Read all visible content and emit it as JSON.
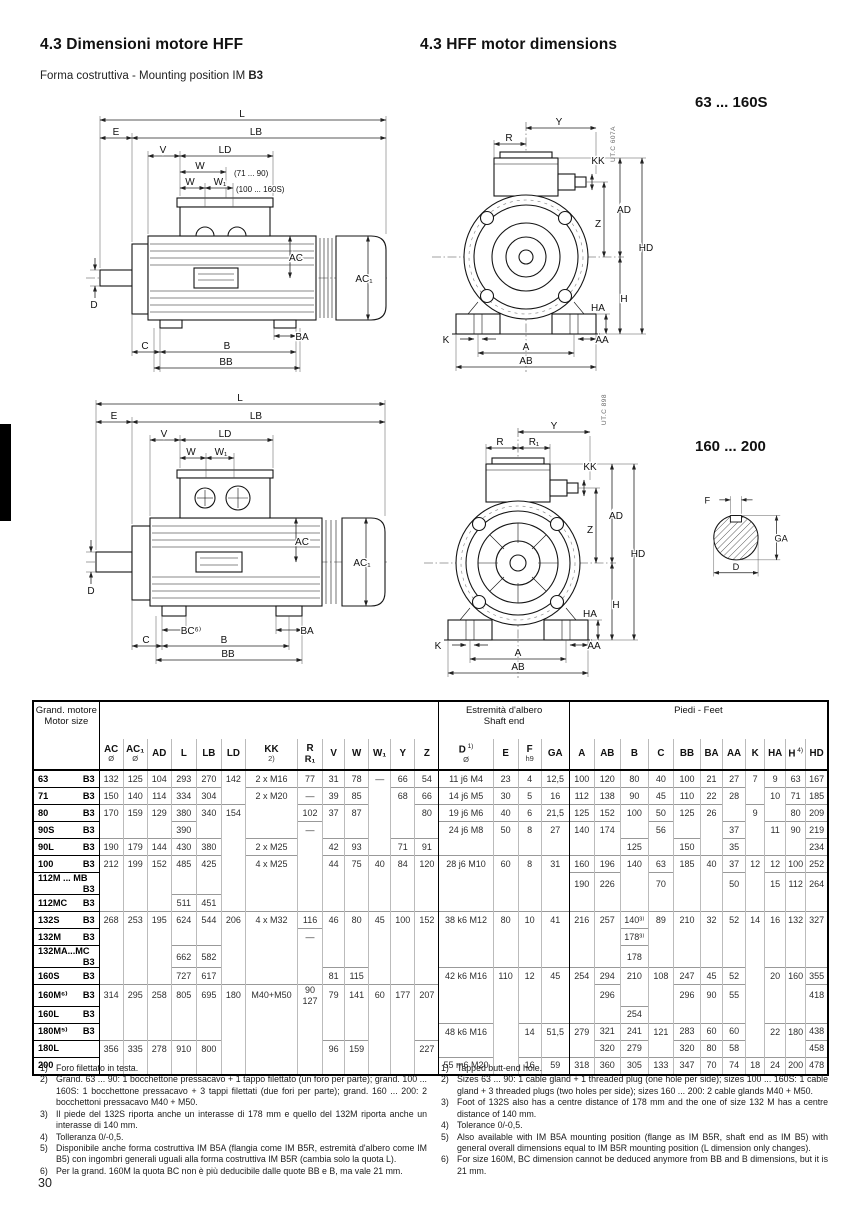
{
  "header": {
    "title_it": "4.3 Dimensioni motore HFF",
    "title_en": "4.3 HFF motor dimensions",
    "subtitle_prefix": "Forma costruttiva - Mounting position IM ",
    "subtitle_bold": "B3"
  },
  "sections": {
    "top_range": "63 ... 160S",
    "bottom_range": "160 ... 200",
    "top_code": "UT.C  607A",
    "bottom_code": "UT.C  898"
  },
  "page": {
    "number": "30"
  },
  "dim": {
    "L": "L",
    "LB": "LB",
    "E": "E",
    "V": "V",
    "LD": "LD",
    "W": "W",
    "W1": "W₁",
    "r7190": "(71  ...  90)",
    "r100160": "(100 ... 160S)",
    "AC": "AC",
    "AC1": "AC₁",
    "D": "D",
    "BA": "BA",
    "C": "C",
    "B": "B",
    "BB": "BB",
    "BC": "BC⁶⁾",
    "Y": "Y",
    "R": "R",
    "R1": "R₁",
    "KK": "KK",
    "AD": "AD",
    "Z": "Z",
    "HD": "HD",
    "HA": "HA",
    "H": "H",
    "K": "K",
    "AA": "AA",
    "A": "A",
    "AB": "AB",
    "F": "F",
    "GA": "GA"
  },
  "table": {
    "motor_size_l1": "Grand. motore",
    "motor_size_l2": "Motor size",
    "shaft_end_l1": "Estremità d'albero",
    "shaft_end_l2": "Shaft end",
    "feet": "Piedi - Feet",
    "columns": [
      {
        "key": "AC",
        "label": "AC",
        "sub": "Ø"
      },
      {
        "key": "AC1",
        "label": "AC₁",
        "sub": "Ø"
      },
      {
        "key": "AD",
        "label": "AD"
      },
      {
        "key": "L",
        "label": "L"
      },
      {
        "key": "LB",
        "label": "LB"
      },
      {
        "key": "LD",
        "label": "LD"
      },
      {
        "key": "KK",
        "label": "KK",
        "sub": "2)"
      },
      {
        "key": "R",
        "label": "R",
        "sub": "R₁",
        "subBold": true
      },
      {
        "key": "V",
        "label": "V"
      },
      {
        "key": "W",
        "label": "W"
      },
      {
        "key": "W1",
        "label": "W₁"
      },
      {
        "key": "Y",
        "label": "Y"
      },
      {
        "key": "Z",
        "label": "Z"
      },
      {
        "key": "D",
        "label": "D",
        "note": "1)",
        "sub": "Ø",
        "bl": true
      },
      {
        "key": "E",
        "label": "E"
      },
      {
        "key": "F",
        "label": "F",
        "sub": "h9"
      },
      {
        "key": "GA",
        "label": "GA"
      },
      {
        "key": "A",
        "label": "A",
        "bl": true
      },
      {
        "key": "AB",
        "label": "AB"
      },
      {
        "key": "B",
        "label": "B"
      },
      {
        "key": "C",
        "label": "C"
      },
      {
        "key": "BB",
        "label": "BB"
      },
      {
        "key": "BA",
        "label": "BA"
      },
      {
        "key": "AA",
        "label": "AA"
      },
      {
        "key": "K",
        "label": "K"
      },
      {
        "key": "HA",
        "label": "HA"
      },
      {
        "key": "H",
        "label": "H",
        "note": "4)"
      },
      {
        "key": "HD",
        "label": "HD"
      }
    ],
    "rows": [
      {
        "size": "63",
        "mount": "B3",
        "cells": [
          "132",
          "125",
          "104",
          "293",
          "270",
          "142",
          "2 x M16",
          "77",
          "31",
          "78",
          "—",
          "66",
          "54",
          "11 j6 M4",
          "23",
          "4",
          "12,5",
          "100",
          "120",
          "80",
          "40",
          "100",
          "21",
          "27",
          "7",
          "9",
          "63",
          "167"
        ]
      },
      {
        "size": "71",
        "mount": "B3",
        "cells": [
          "150",
          "140",
          "114",
          "334",
          "304",
          "",
          "2 x M20",
          "—",
          "39",
          "85",
          "",
          "68",
          "66",
          "14 j6 M5",
          "30",
          "5",
          "16",
          "112",
          "138",
          "90",
          "45",
          "110",
          "22",
          "28",
          "",
          "10",
          "71",
          "185"
        ]
      },
      {
        "size": "80",
        "mount": "B3",
        "cells": [
          "170",
          "159",
          "129",
          "380",
          "340",
          "154",
          "",
          "102",
          "37",
          "87",
          "",
          "",
          "80",
          "19 j6 M6",
          "40",
          "6",
          "21,5",
          "125",
          "152",
          "100",
          "50",
          "125",
          "26",
          "",
          "9",
          "",
          "80",
          "209"
        ]
      },
      {
        "size": "90S",
        "mount": "B3",
        "cells": [
          "",
          "",
          "",
          "390",
          "",
          "",
          "",
          "—",
          "",
          "",
          "",
          "",
          "",
          "24 j6 M8",
          "50",
          "8",
          "27",
          "140",
          "174",
          "",
          "56",
          "",
          "",
          "37",
          "",
          "11",
          "90",
          "219"
        ]
      },
      {
        "size": "90L",
        "mount": "B3",
        "cells": [
          "190",
          "179",
          "144",
          "430",
          "380",
          "",
          "2 x M25",
          "",
          "42",
          "93",
          "",
          "71",
          "91",
          "",
          "",
          "",
          "",
          "",
          "",
          "125",
          "",
          "150",
          "",
          "35",
          "",
          "",
          "",
          "234"
        ]
      },
      {
        "size": "100",
        "mount": "B3",
        "cells": [
          "212",
          "199",
          "152",
          "485",
          "425",
          "",
          "4 x M25",
          "",
          "44",
          "75",
          "40",
          "84",
          "120",
          "28 j6 M10",
          "60",
          "8",
          "31",
          "160",
          "196",
          "140",
          "63",
          "185",
          "40",
          "37",
          "12",
          "12",
          "100",
          "252"
        ]
      },
      {
        "size": "112M ... MB",
        "mount": "B3",
        "cells": [
          "",
          "",
          "",
          "",
          "",
          "",
          "",
          "",
          "",
          "",
          "",
          "",
          "",
          "",
          "",
          "",
          "",
          "190",
          "226",
          "",
          "70",
          "",
          "",
          "50",
          "",
          "15",
          "112",
          "264"
        ]
      },
      {
        "size": "112MC",
        "mount": "B3",
        "cells": [
          "",
          "",
          "",
          "511",
          "451",
          "",
          "",
          "",
          "",
          "",
          "",
          "",
          "",
          "",
          "",
          "",
          "",
          "",
          "",
          "",
          "",
          "",
          "",
          "",
          "",
          "",
          "",
          ""
        ]
      },
      {
        "size": "132S",
        "mount": "B3",
        "cells": [
          "268",
          "253",
          "195",
          "624",
          "544",
          "206",
          "4 x M32",
          "116",
          "46",
          "80",
          "45",
          "100",
          "152",
          "38 k6 M12",
          "80",
          "10",
          "41",
          "216",
          "257",
          "140³⁾",
          "89",
          "210",
          "32",
          "52",
          "14",
          "16",
          "132",
          "327"
        ]
      },
      {
        "size": "132M",
        "mount": "B3",
        "cells": [
          "",
          "",
          "",
          "",
          "",
          "",
          "",
          "—",
          "",
          "",
          "",
          "",
          "",
          "",
          "",
          "",
          "",
          "",
          "",
          "178³⁾",
          "",
          "",
          "",
          "",
          "",
          "",
          "",
          ""
        ]
      },
      {
        "size": "132MA...MC",
        "mount": "B3",
        "cells": [
          "",
          "",
          "",
          "662",
          "582",
          "",
          "",
          "",
          "",
          "",
          "",
          "",
          "",
          "",
          "",
          "",
          "",
          "",
          "",
          "178",
          "",
          "",
          "",
          "",
          "",
          "",
          "",
          ""
        ]
      },
      {
        "size": "160S",
        "mount": "B3",
        "cells": [
          "",
          "",
          "",
          "727",
          "617",
          "",
          "",
          "",
          "81",
          "115",
          "",
          "",
          "",
          "42 k6 M16",
          "110",
          "12",
          "45",
          "254",
          "294",
          "210",
          "108",
          "247",
          "45",
          "52",
          "",
          "20",
          "160",
          "355"
        ]
      },
      {
        "size": "160M⁶⁾",
        "mount": "B3",
        "cells": [
          "314",
          "295",
          "258",
          "805",
          "695",
          "180",
          "M40+M50",
          "90\n127",
          "79",
          "141",
          "60",
          "177",
          "207",
          "",
          "",
          "",
          "",
          "",
          "296",
          "",
          "",
          "296",
          "90",
          "55",
          "",
          "",
          "",
          "418"
        ]
      },
      {
        "size": "160L",
        "mount": "B3",
        "cells": [
          "",
          "",
          "",
          "",
          "",
          "",
          "",
          "",
          "",
          "",
          "",
          "",
          "",
          "",
          "",
          "",
          "",
          "",
          "",
          "254",
          "",
          "",
          "",
          "",
          "",
          "",
          "",
          ""
        ]
      },
      {
        "size": "180M⁵⁾",
        "mount": "B3",
        "cells": [
          "",
          "",
          "",
          "",
          "",
          "",
          "",
          "",
          "",
          "",
          "",
          "",
          "",
          "48 k6 M16",
          "",
          "14",
          "51,5",
          "279",
          "321",
          "241",
          "121",
          "283",
          "60",
          "60",
          "",
          "22",
          "180",
          "438"
        ]
      },
      {
        "size": "180L",
        "mount": "",
        "cells": [
          "356",
          "335",
          "278",
          "910",
          "800",
          "",
          "",
          "",
          "96",
          "159",
          "",
          "",
          "227",
          "",
          "",
          "",
          "",
          "",
          "320",
          "279",
          "",
          "320",
          "80",
          "58",
          "",
          "",
          "",
          "458"
        ]
      },
      {
        "size": "200",
        "mount": "",
        "cells": [
          "",
          "",
          "",
          "",
          "",
          "",
          "",
          "",
          "",
          "",
          "",
          "",
          "",
          "55 m6 M20",
          "",
          "16",
          "59",
          "318",
          "360",
          "305",
          "133",
          "347",
          "70",
          "74",
          "18",
          "24",
          "200",
          "478"
        ]
      }
    ]
  },
  "footnotes": {
    "it": [
      {
        "n": "1)",
        "t": "Foro filettato in testa."
      },
      {
        "n": "2)",
        "t": "Grand. 63 ... 90: 1 bocchettone pressacavo + 1 tappo filettato (un foro per parte); grand. 100 ... 160S: 1 bocchettone pressacavo + 3 tappi filettati (due fori per parte); grand. 160 ... 200: 2 bocchettoni pressacavo M40 + M50."
      },
      {
        "n": "3)",
        "t": "Il piede del 132S riporta anche un interasse di 178 mm e quello del 132M riporta anche un interasse di 140 mm."
      },
      {
        "n": "4)",
        "t": "Tolleranza 0/-0,5."
      },
      {
        "n": "5)",
        "t": "Disponibile anche forma costruttiva IM B5A (flangia come IM B5R, estremità d'albero come IM B5) con ingombri generali uguali alla forma costruttiva IM B5R (cambia solo la quota L)."
      },
      {
        "n": "6)",
        "t": "Per la grand. 160M la quota BC non è più deducibile dalle quote BB e B, ma vale 21 mm."
      }
    ],
    "en": [
      {
        "n": "1)",
        "t": "Tapped butt-end hole."
      },
      {
        "n": "2)",
        "t": "Sizes 63 ... 90: 1 cable gland + 1 threaded plug (one hole per side); sizes 100 ... 160S: 1 cable gland + 3 threaded plugs (two holes per side); sizes 160 ... 200: 2 cable glands M40 + M50."
      },
      {
        "n": "3)",
        "t": "Foot of 132S also has a centre distance of 178 mm and the one of size 132 M has a centre distance of 140 mm."
      },
      {
        "n": "4)",
        "t": "Tolerance 0/-0,5."
      },
      {
        "n": "5)",
        "t": "Also available with IM B5A mounting position (flange as IM B5R, shaft end as IM B5) with general overall dimensions equal to IM B5R mounting position (L dimension only changes)."
      },
      {
        "n": "6)",
        "t": "For size 160M, BC dimension cannot be deduced anymore from BB and B dimensions, but it is 21 mm."
      }
    ]
  }
}
